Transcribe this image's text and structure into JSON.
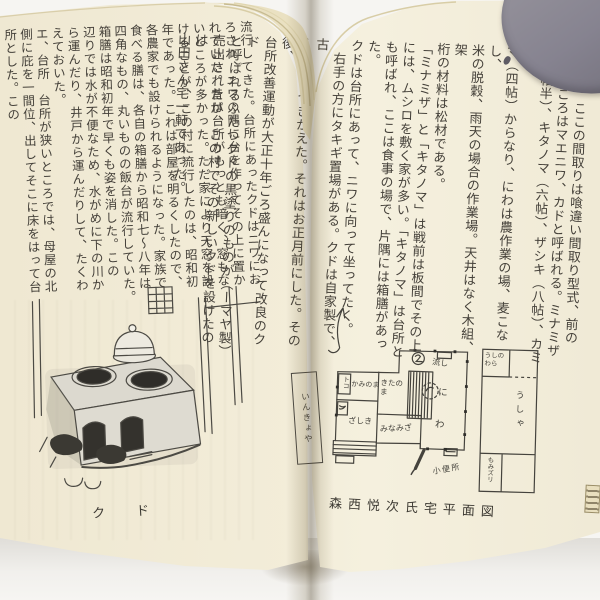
{
  "colors": {
    "background": "#f6f5f2",
    "page_cream": "#f2ecd7",
    "page_edge_tan": "#cfc49e",
    "ink_text": "#45413a",
    "sketch_ink": "#4a4843",
    "gray_tab": "#84818b"
  },
  "left_page": {
    "text_columns": [
      "流行してきた。台所にあったクドはニワにお",
      "ろされ、ニワの隅に台を作ってその上に置か",
      "れていた。昔は台所がもっとも暗く、窓もな",
      "いところが多かった。ただ家により天窓を設",
      "けることが、この村に流行したのは、昭和初",
      "年であった。これは部屋を明るくしたので、",
      "各農家でも設けられるようになった。家族で",
      "食べる膳は、各自の箱膳から昭和七〜八年は",
      "四角なもの、丸いものの飯台が流行していた。",
      "箱膳は昭和初年で早くも姿を消した。この",
      "辺りでは水が不便なため、水がめに下の川か",
      "ら運んだり、井戸から運んだりして、たくわ",
      "えておいた。",
      "エ、台所　台所が狭いところでは、母屋の北",
      "側に庇を一間位、出してそこに床をはって台",
      "所とした。この"
    ],
    "illustration_caption": "ク　ド"
  },
  "right_page": {
    "text_columns": [
      "間取り　ここの間取りは喰違い間取り型式、前の",
      "広いところはマエニワ、カドと呼ばれる。ミナミザ",
      "（四帖半）、キタノマ（六帖）、ザシキ（八帖）、カミノ",
      "マ（四帖）からなり、にわは農作業の場、麦こなし、",
      "米の脱穀、雨天の場合の作業場。天井はなく木組、架",
      "桁の材料は松材である。",
      "「ミナミザ」と「キタノマ」は戦前は板間でその上",
      "には、ムシロを敷く家が多い。「キタノマ」は台所と",
      "も呼ばれ、ここは食事の場で、片隅には箱膳があった。",
      "クドは台所にあって、ニワに向って坐ってたく。",
      "　右手の方にタキギ置場がある。クドは自家製で、古",
      "くなるとつきかえた。それはお正月前にした。その後、",
      "台所改善運動が大正十年ごろ盛んになって改良のクド",
      "と呼ばれるふたつクドの黒塗りのものが（ーマヤ製）",
      "売出されたが、この村でその新しいクドを設けたのは",
      "山田さん宅一軒であった。"
    ],
    "plan_caption": "森西悦次氏宅平面図",
    "floor_plan": {
      "toko": "トコ",
      "kaminoma": "かみのま",
      "kitanoma": "きたのま",
      "zashiki": "ざしき",
      "minamiza": "みなみざ",
      "nagashi": "流し",
      "niwa_ni": "に",
      "niwa_wa": "わ",
      "outside_label": "小便所",
      "annex_label": "いんきょや"
    },
    "barn_plan": {
      "ushinowara": "うしのわら",
      "ushiya": "うしゃ",
      "momizuri": "もみズリ"
    }
  }
}
